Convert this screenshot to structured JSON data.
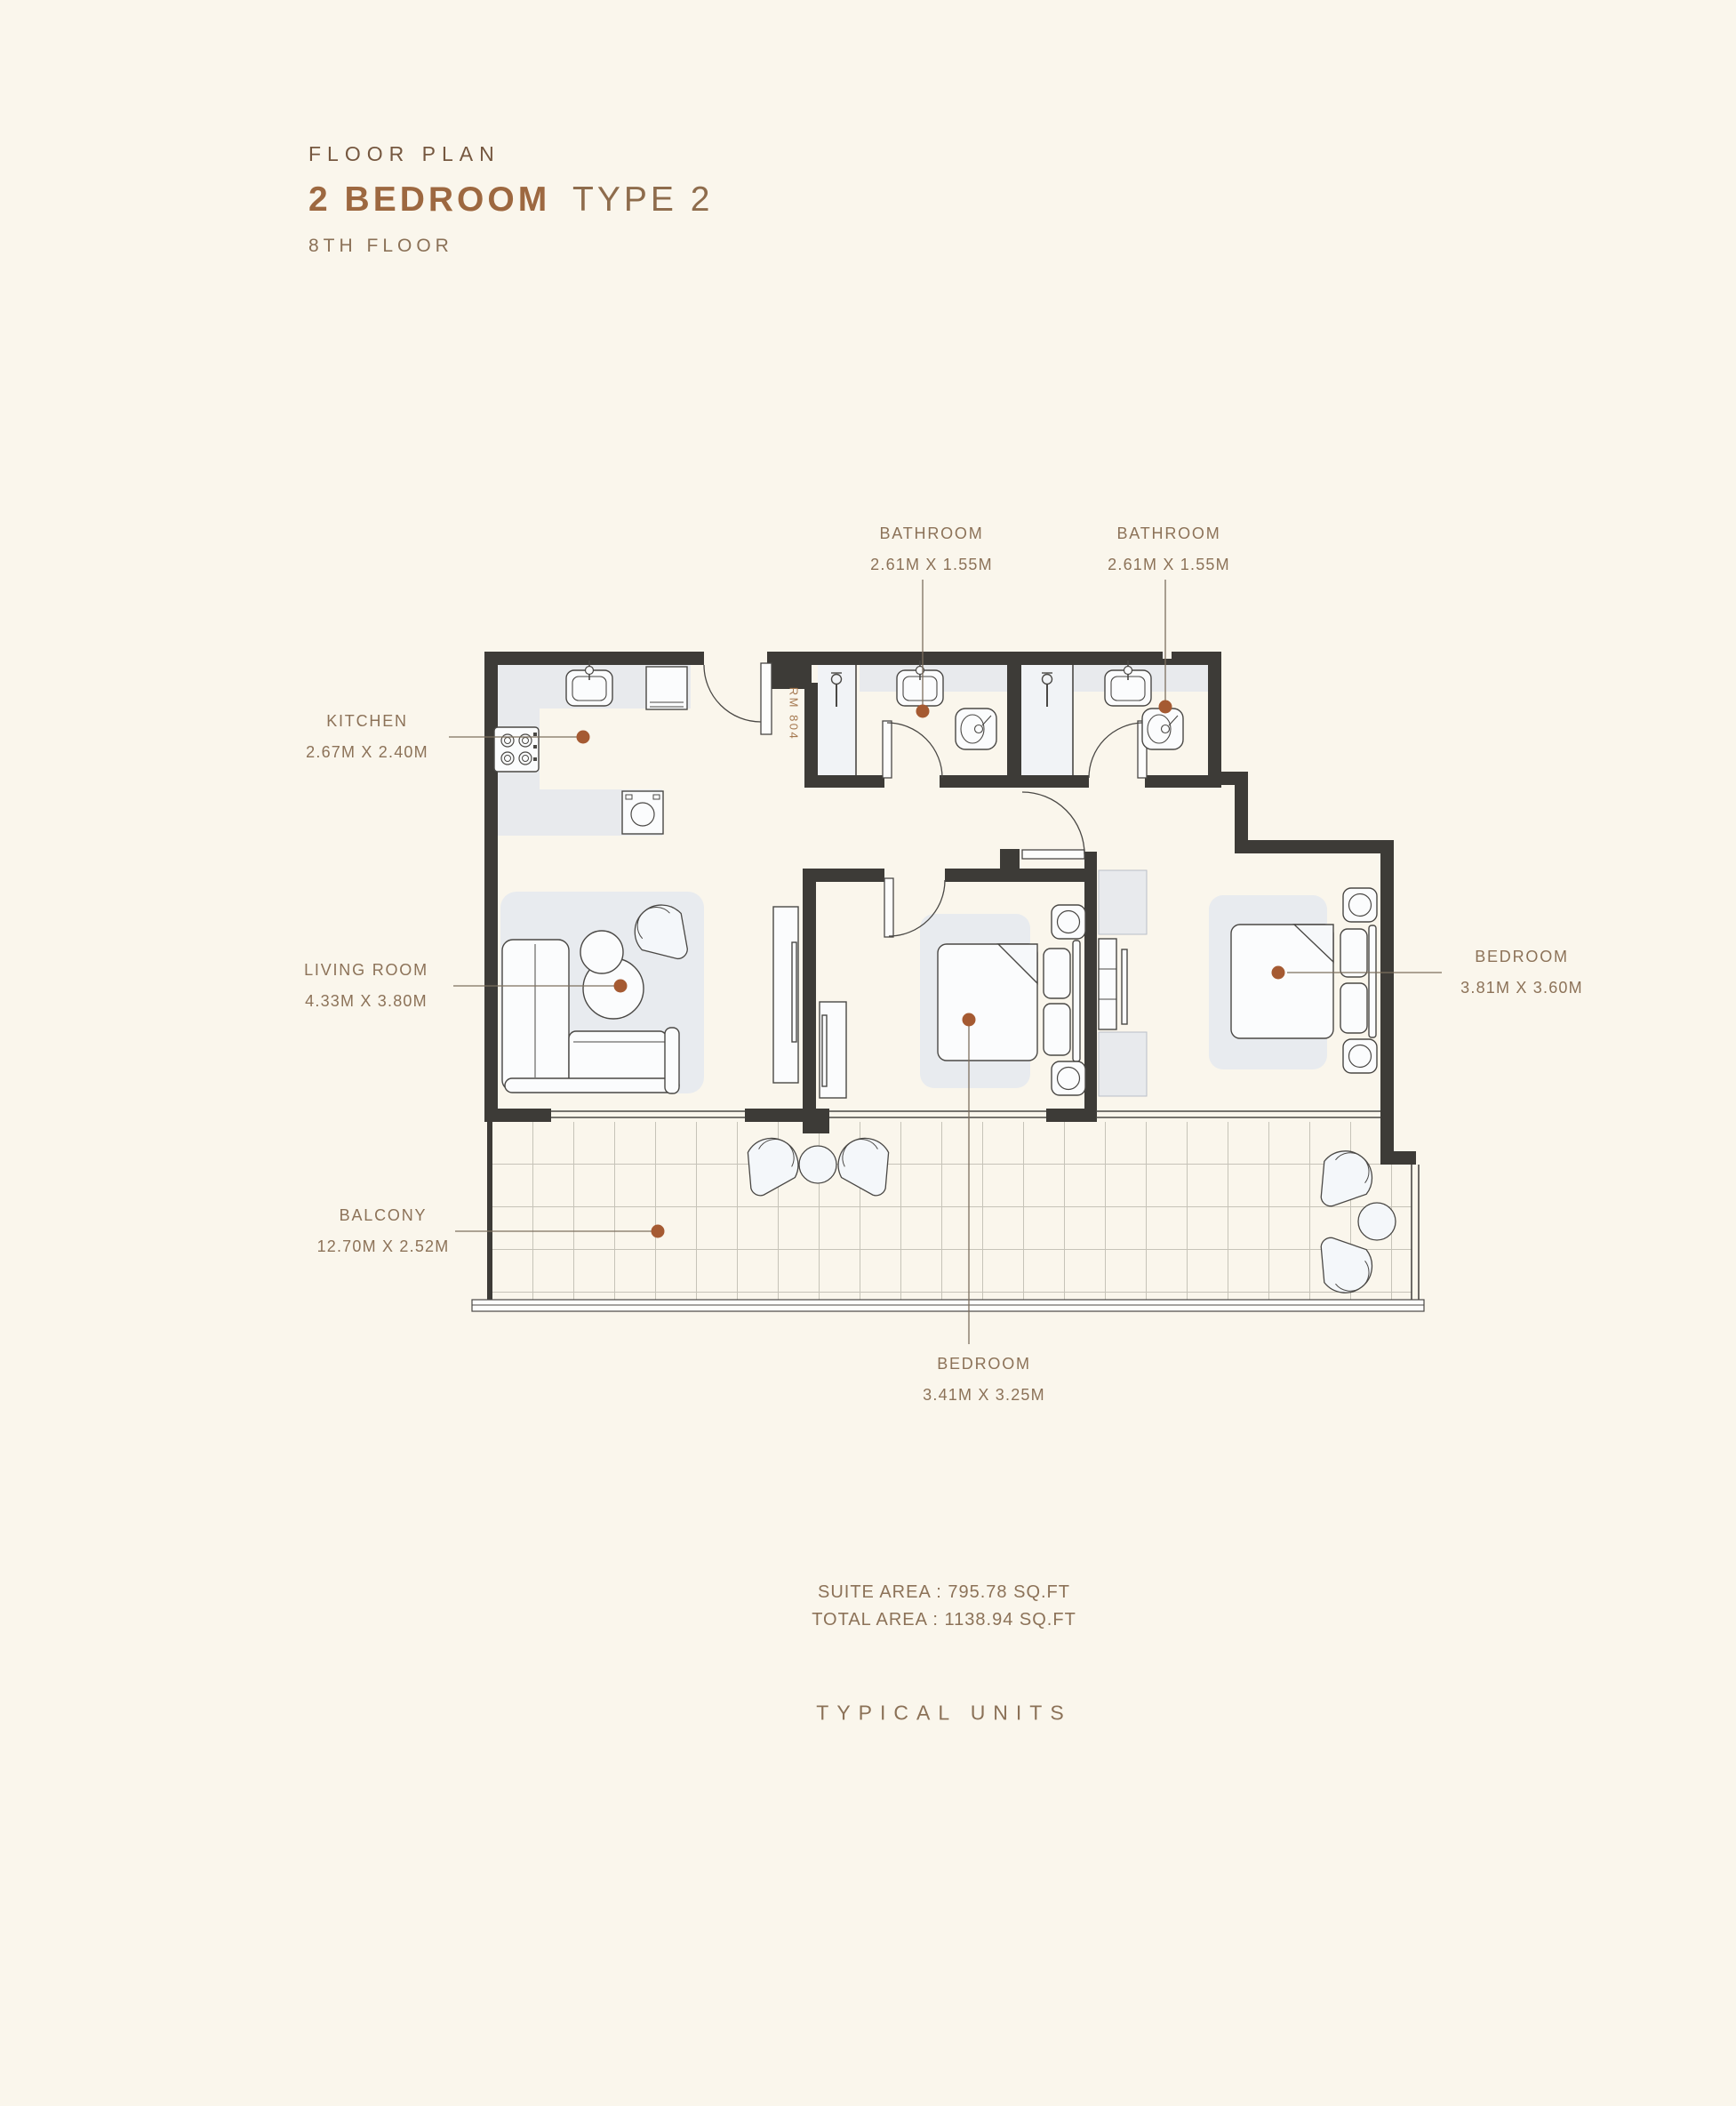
{
  "header": {
    "eyebrow": "FLOOR PLAN",
    "title_bold": "2 BEDROOM",
    "title_light": "TYPE 2",
    "subtitle": "8TH FLOOR"
  },
  "unit": {
    "room_number": "RM 804"
  },
  "labels": [
    {
      "id": "bathroom-1",
      "name": "BATHROOM",
      "dims": "2.61M X 1.55M"
    },
    {
      "id": "bathroom-2",
      "name": "BATHROOM",
      "dims": "2.61M X 1.55M"
    },
    {
      "id": "kitchen",
      "name": "KITCHEN",
      "dims": "2.67M X 2.40M"
    },
    {
      "id": "living-room",
      "name": "LIVING ROOM",
      "dims": "4.33M X 3.80M"
    },
    {
      "id": "bedroom-right",
      "name": "BEDROOM",
      "dims": "3.81M X 3.60M"
    },
    {
      "id": "balcony",
      "name": "BALCONY",
      "dims": "12.70M X 2.52M"
    },
    {
      "id": "bedroom-bottom",
      "name": "BEDROOM",
      "dims": "3.41M X 3.25M"
    }
  ],
  "areas": {
    "suite": "SUITE AREA : 795.78 SQ.FT",
    "total": "TOTAL AREA : 1138.94 SQ.FT"
  },
  "footer": "TYPICAL UNITS",
  "colors": {
    "background": "#FAF6EC",
    "wall": "#3D3B37",
    "accent_dot": "#A55A32",
    "label_text": "#8C7258",
    "title_bold": "#9D6840",
    "gray_fill": "#E8EAED"
  }
}
